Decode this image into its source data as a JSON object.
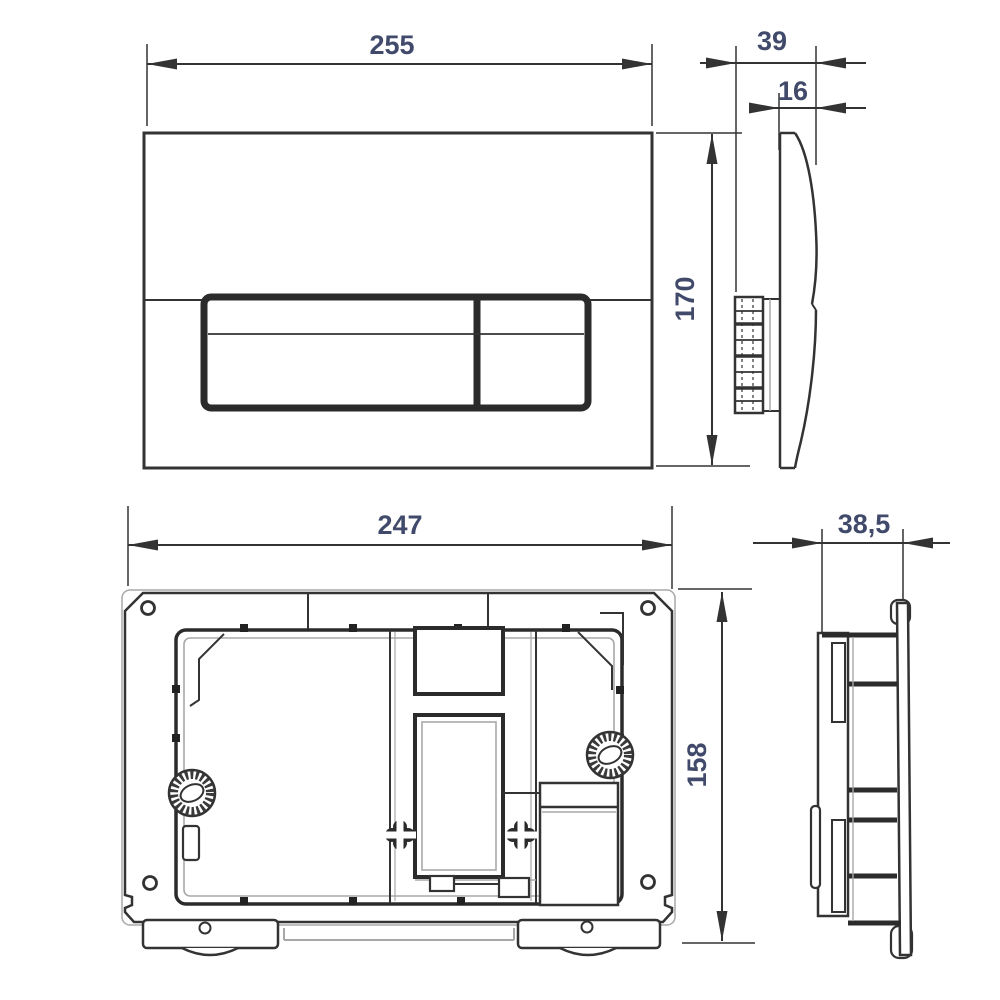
{
  "drawing": {
    "type": "technical-dimension-drawing",
    "subject": "toilet flush actuator plate and mounting frame, four orthographic views",
    "colors": {
      "background": "#ffffff",
      "line": "#333333",
      "shadow_line": "#a8a8a8",
      "dimension_label": "#414a6b"
    },
    "views": {
      "plate_front": {
        "label": "flush-plate-front-view",
        "dims": {
          "width": "255",
          "height": "170"
        }
      },
      "plate_side": {
        "label": "flush-plate-side-view",
        "dims": {
          "depth": "39",
          "thickness": "16"
        }
      },
      "frame_rear": {
        "label": "mounting-frame-front-view",
        "dims": {
          "width": "247",
          "height": "158"
        }
      },
      "frame_side": {
        "label": "mounting-frame-side-view",
        "dims": {
          "depth": "38,5"
        }
      }
    }
  }
}
